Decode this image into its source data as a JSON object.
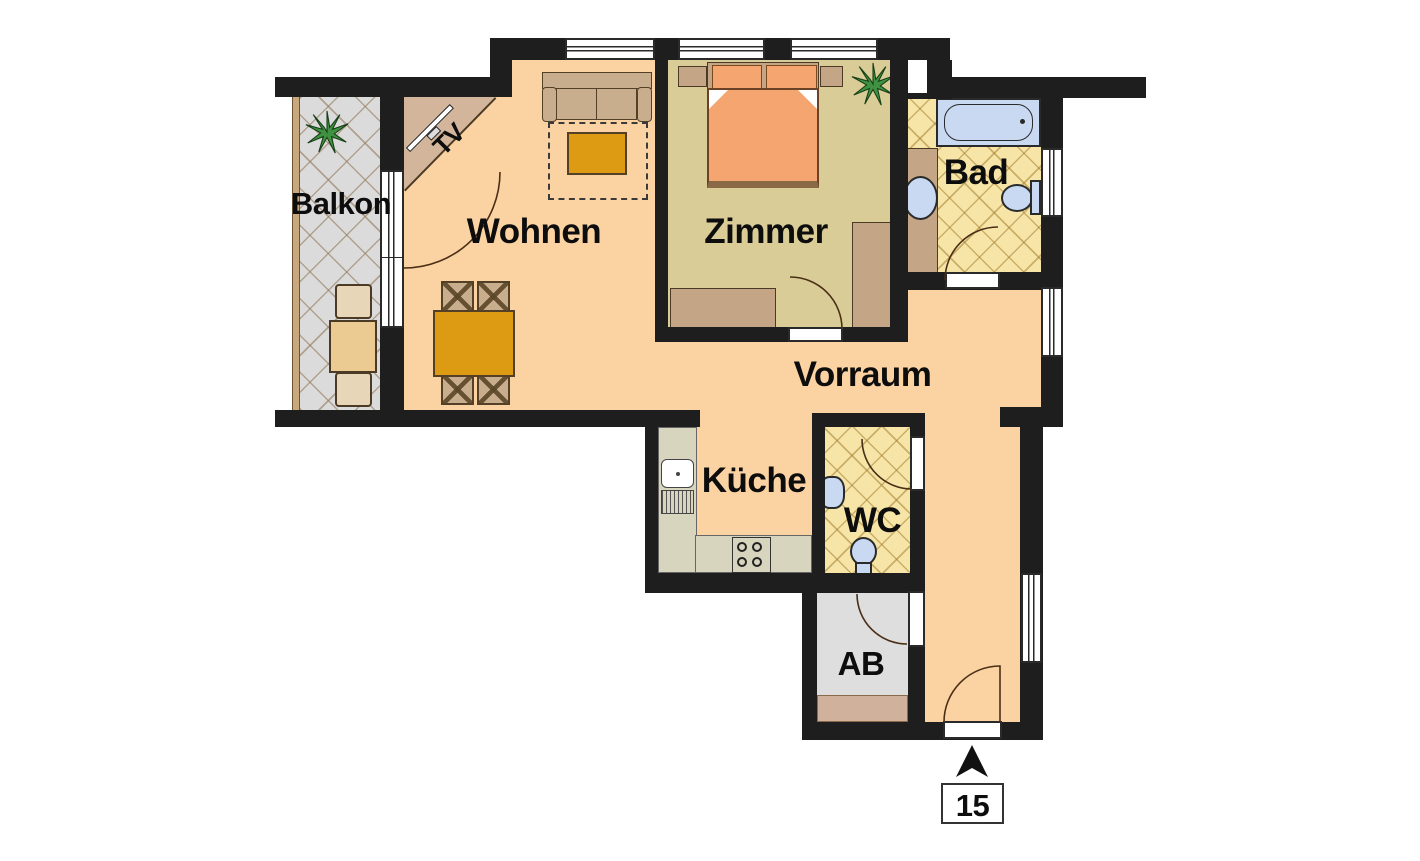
{
  "floor_plan": {
    "unit_number": "15",
    "rooms": {
      "balkon": {
        "label": "Balkon"
      },
      "wohnen": {
        "label": "Wohnen"
      },
      "zimmer": {
        "label": "Zimmer"
      },
      "bad": {
        "label": "Bad"
      },
      "vorraum": {
        "label": "Vorraum"
      },
      "kueche": {
        "label": "Küche"
      },
      "wc": {
        "label": "WC"
      },
      "ab": {
        "label": "AB"
      }
    },
    "annotations": {
      "tv_label": "TV"
    },
    "colors": {
      "wall": "#1e1e1e",
      "floor_living": "#FBD3A2",
      "floor_bedroom": "#D9CC96",
      "floor_bath": "#F6E5A7",
      "floor_balcony": "#DBDBDB",
      "floor_storage": "#DEDEDE",
      "furniture_wood": "#C4A585",
      "furniture_accent": "#DD9B13",
      "bed": "#F5A570",
      "fixtures_blue": "#C9D9F2",
      "kitchen_counter": "#D8D5BF",
      "plant_green": "#3F9242"
    }
  }
}
